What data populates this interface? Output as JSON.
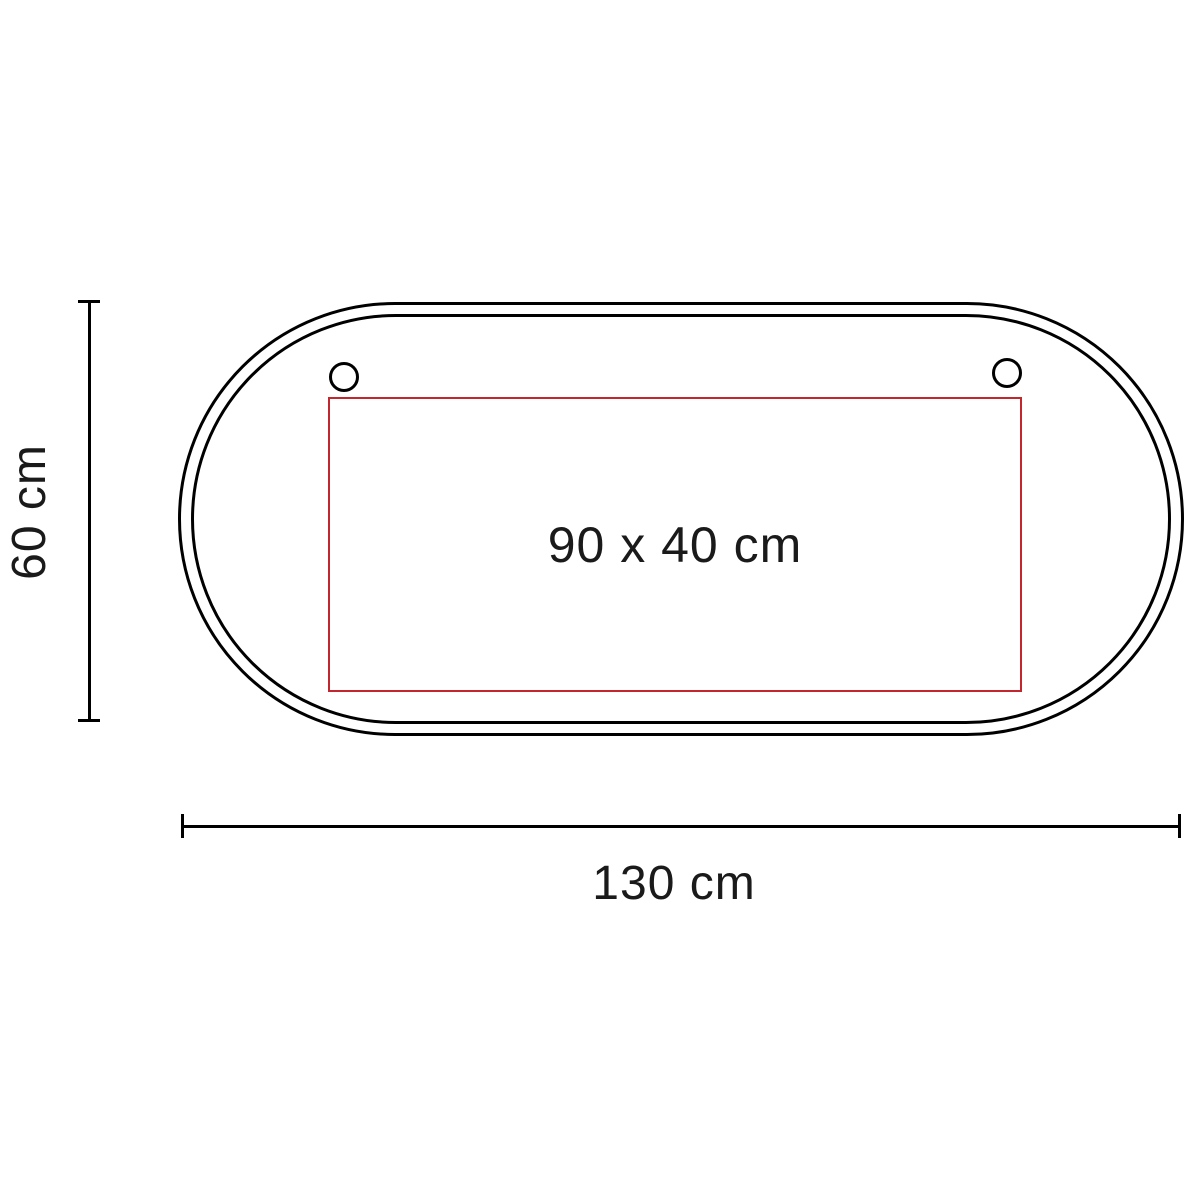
{
  "diagram": {
    "type": "product-dimension-diagram",
    "shape": "stadium-oval",
    "labels": {
      "print_area": "90 x 40 cm",
      "total_width": "130 cm",
      "total_height": "60 cm"
    },
    "colors": {
      "outline": "#000000",
      "print_area_border": "#c1272d",
      "text": "#1a1a1a",
      "background": "#ffffff"
    },
    "features": {
      "outline_style": "double",
      "grommet_count": 2
    }
  }
}
